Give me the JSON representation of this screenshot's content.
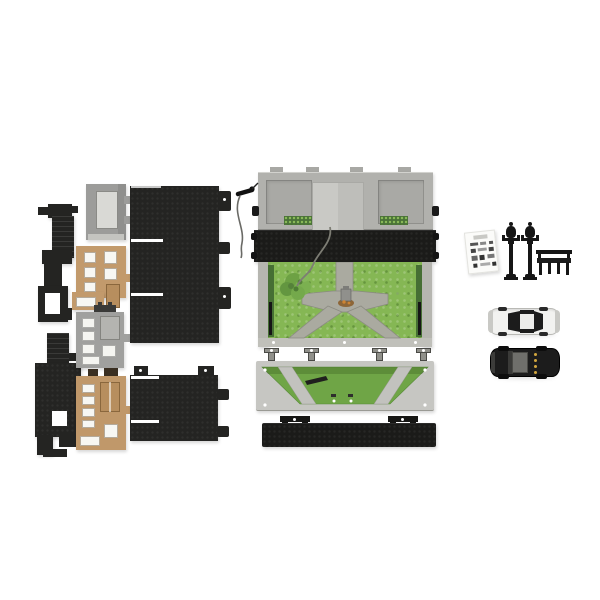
{
  "image": {
    "kind": "product-photo",
    "background": "#ffffff",
    "subject": "Disassembled miniature diorama playset parts arranged flat on a white background"
  },
  "palette": {
    "black_plastic": "#242422",
    "dark_road": "#1d1d1b",
    "gray_plastic": "#b1b1ad",
    "light_gray_plate": "#c6c6c2",
    "tan_plastic": "#c29a6c",
    "grass_green": "#85b754",
    "hedge_green": "#466f34",
    "path_gray": "#aaaaa0",
    "statue_base_brown": "#8a5e2c",
    "accent_orange": "#cd8434",
    "taillight_gold": "#d2a63e",
    "white_car_body": "#f2f2f0"
  },
  "parts": {
    "trim_upper": {
      "title": "Black trim piece with cut-outs and ring opening"
    },
    "trim_lower": {
      "title": "Black trim piece with square opening and feet"
    },
    "gray_frame": {
      "title": "Gray door-frame part with side tabs"
    },
    "tan_facade_small": {
      "title": "Tan building facade with five windows"
    },
    "gray_facade": {
      "title": "Gray building facade with windows and roof cap"
    },
    "tan_facade_tall": {
      "title": "Tall tan building facade with window ladder"
    },
    "black_panel_large": {
      "title": "Large black base panel with three side tabs"
    },
    "black_panel_small": {
      "title": "Small black base panel with top clips"
    },
    "wall": {
      "title": "Gray wall section with central ramp and hedge boxes"
    },
    "road": {
      "title": "Black road strip"
    },
    "park": {
      "title": "Green park base with Y-shaped paths, tree, hedges and statue"
    },
    "clips_row": {
      "title": "Four mounting clips"
    },
    "under_plate": {
      "title": "Gray plate with green ramp surface and diagonal struts"
    },
    "curb": {
      "title": "Black curb strip with two clips"
    },
    "wires": {
      "title": "Thin hanging wire with connector and cable"
    },
    "decal_sheet": {
      "title": "Small white decal sheet"
    },
    "lamp_1": {
      "title": "Black street lamp"
    },
    "lamp_2": {
      "title": "Black street lamp"
    },
    "bench": {
      "title": "Black park bench"
    },
    "car_white": {
      "title": "White toy car, top view"
    },
    "car_black": {
      "title": "Black toy car, top view"
    }
  }
}
